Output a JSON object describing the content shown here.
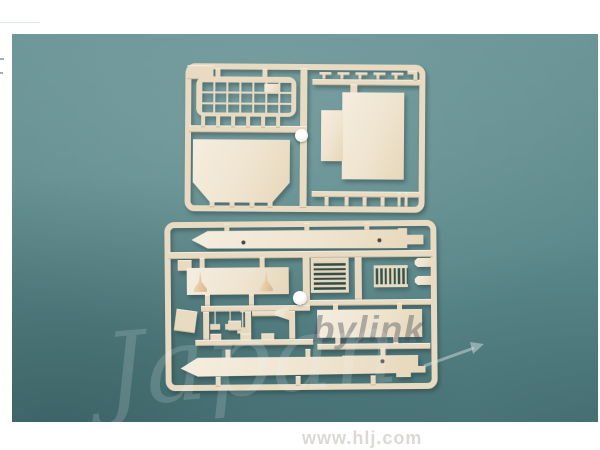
{
  "scene": {
    "subject": "two cream plastic model-kit sprues photographed on a teal background",
    "upper_sprue_parts": [
      "mesh grille panel",
      "stepped rectangular panel",
      "chamfered rectangular panel",
      "small brackets",
      "ejector dot"
    ],
    "lower_sprue_parts": [
      "upper hull half",
      "deck panel with two cone ventilators",
      "horizontal slat grille",
      "vertical slat grille",
      "equipment box panel",
      "small deck fittings",
      "lower hull half",
      "ejector dot"
    ]
  },
  "colors": {
    "background_teal": "#5e8b8d",
    "sprue_cream": "#e8dbc2",
    "panel_cream": "#f2e9d8",
    "photo_border_white": "#ffffff",
    "url_text": "#dbd9d5",
    "watermark_dark": "#464c54",
    "watermark_light": "#eef5f3"
  },
  "watermarks": {
    "brand_fragment": "bylink",
    "brand_script": "Japan",
    "site_url": "www.hlj.com"
  }
}
